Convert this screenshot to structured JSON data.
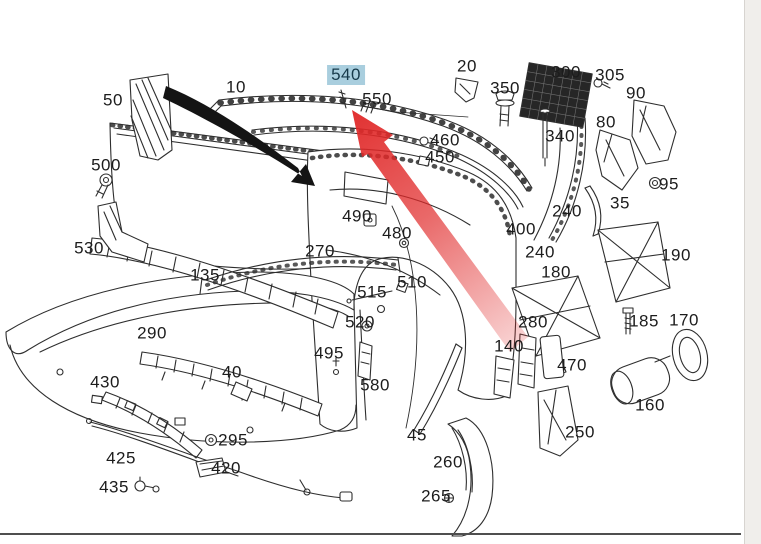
{
  "theme": {
    "highlight": "#a9cede",
    "label": "#1c1c1c",
    "line": "#2e2e2e",
    "accent_blue": "#2ba6dc",
    "divider": "#4f4f4f",
    "sidebar_bg": "#f0eeeb",
    "red_arrow": "#e02828",
    "black_arrow": "#141414",
    "window_edge": "#1d2b3a",
    "dot_red": "#6b2018"
  },
  "diagram": {
    "title": "rear-bumper exploded parts diagram",
    "highlighted_part": "540",
    "labels": [
      {
        "text": "50",
        "x": 113,
        "y": 100,
        "highlighted": false
      },
      {
        "text": "10",
        "x": 236,
        "y": 87,
        "highlighted": false
      },
      {
        "text": "540",
        "x": 346,
        "y": 75,
        "highlighted": true
      },
      {
        "text": "550",
        "x": 377,
        "y": 99,
        "highlighted": false
      },
      {
        "text": "20",
        "x": 467,
        "y": 66,
        "highlighted": false
      },
      {
        "text": "350",
        "x": 505,
        "y": 88,
        "highlighted": false
      },
      {
        "text": "300",
        "x": 566,
        "y": 72,
        "highlighted": false
      },
      {
        "text": "305",
        "x": 610,
        "y": 75,
        "highlighted": false
      },
      {
        "text": "90",
        "x": 636,
        "y": 93,
        "highlighted": false
      },
      {
        "text": "80",
        "x": 606,
        "y": 122,
        "highlighted": false
      },
      {
        "text": "340",
        "x": 560,
        "y": 136,
        "highlighted": false
      },
      {
        "text": "460",
        "x": 445,
        "y": 140,
        "highlighted": false
      },
      {
        "text": "450",
        "x": 440,
        "y": 157,
        "highlighted": false
      },
      {
        "text": "95",
        "x": 669,
        "y": 184,
        "highlighted": false
      },
      {
        "text": "35",
        "x": 620,
        "y": 203,
        "highlighted": false
      },
      {
        "text": "240",
        "x": 567,
        "y": 211,
        "highlighted": false
      },
      {
        "text": "400",
        "x": 521,
        "y": 229,
        "highlighted": false
      },
      {
        "text": "240",
        "x": 540,
        "y": 252,
        "highlighted": false
      },
      {
        "text": "190",
        "x": 676,
        "y": 255,
        "highlighted": false
      },
      {
        "text": "180",
        "x": 556,
        "y": 272,
        "highlighted": false
      },
      {
        "text": "500",
        "x": 106,
        "y": 165,
        "highlighted": false
      },
      {
        "text": "530",
        "x": 89,
        "y": 248,
        "highlighted": false
      },
      {
        "text": "135",
        "x": 205,
        "y": 275,
        "highlighted": false
      },
      {
        "text": "490",
        "x": 357,
        "y": 216,
        "highlighted": false
      },
      {
        "text": "480",
        "x": 397,
        "y": 233,
        "highlighted": false
      },
      {
        "text": "270",
        "x": 320,
        "y": 251,
        "highlighted": false
      },
      {
        "text": "510",
        "x": 412,
        "y": 282,
        "highlighted": false
      },
      {
        "text": "515",
        "x": 372,
        "y": 292,
        "highlighted": false
      },
      {
        "text": "520",
        "x": 360,
        "y": 322,
        "highlighted": false
      },
      {
        "text": "290",
        "x": 152,
        "y": 333,
        "highlighted": false
      },
      {
        "text": "280",
        "x": 533,
        "y": 322,
        "highlighted": false
      },
      {
        "text": "185",
        "x": 644,
        "y": 321,
        "highlighted": false
      },
      {
        "text": "170",
        "x": 684,
        "y": 320,
        "highlighted": false
      },
      {
        "text": "140",
        "x": 509,
        "y": 346,
        "highlighted": false
      },
      {
        "text": "470",
        "x": 572,
        "y": 365,
        "highlighted": false
      },
      {
        "text": "495",
        "x": 329,
        "y": 353,
        "highlighted": false
      },
      {
        "text": "580",
        "x": 375,
        "y": 385,
        "highlighted": false
      },
      {
        "text": "40",
        "x": 232,
        "y": 372,
        "highlighted": false
      },
      {
        "text": "430",
        "x": 105,
        "y": 382,
        "highlighted": false
      },
      {
        "text": "45",
        "x": 417,
        "y": 435,
        "highlighted": false
      },
      {
        "text": "160",
        "x": 650,
        "y": 405,
        "highlighted": false
      },
      {
        "text": "250",
        "x": 580,
        "y": 432,
        "highlighted": false
      },
      {
        "text": "260",
        "x": 448,
        "y": 462,
        "highlighted": false
      },
      {
        "text": "265",
        "x": 436,
        "y": 496,
        "highlighted": false
      },
      {
        "text": "295",
        "x": 233,
        "y": 440,
        "highlighted": false
      },
      {
        "text": "425",
        "x": 121,
        "y": 458,
        "highlighted": false
      },
      {
        "text": "420",
        "x": 226,
        "y": 468,
        "highlighted": false
      },
      {
        "text": "435",
        "x": 114,
        "y": 487,
        "highlighted": false
      }
    ]
  },
  "callouts": {
    "red_arrow": {
      "color": "#e02828",
      "tip_x": 352,
      "tip_y": 110,
      "tail_x": 520,
      "tail_y": 345
    },
    "black_arrow": {
      "color": "#141414",
      "start_x": 168,
      "start_y": 88,
      "end_x": 315,
      "end_y": 186
    }
  },
  "sidebar": {
    "icons": [
      "window-edge",
      "circle-tool-icon",
      "flag-tool-icon",
      "small-dash-icon",
      "chevron-right-icon",
      "chevron-right-icon",
      "red-dot-icon"
    ]
  }
}
